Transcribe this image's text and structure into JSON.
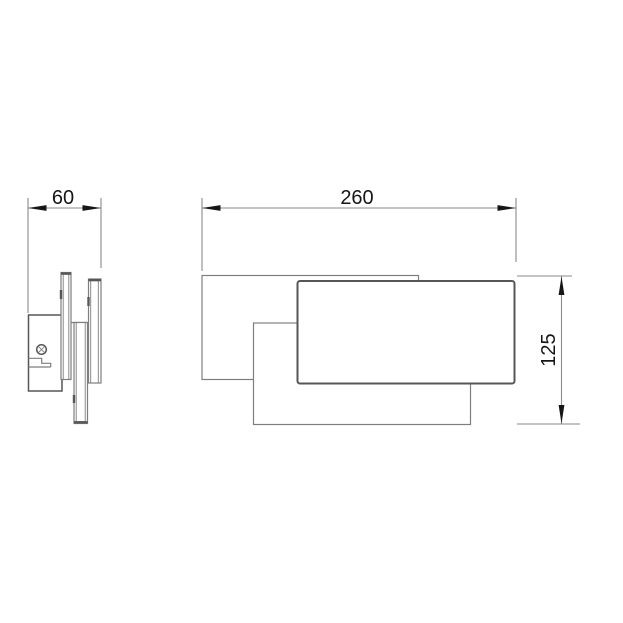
{
  "drawing": {
    "type": "technical-dimension-drawing",
    "views": {
      "side_view": {
        "dimension": {
          "label": "60",
          "orientation": "horizontal"
        }
      },
      "front_view": {
        "dimension_width": {
          "label": "260",
          "orientation": "horizontal"
        },
        "dimension_height": {
          "label": "125",
          "orientation": "vertical-rotated"
        }
      }
    },
    "dimensions": {
      "depth": "60",
      "width": "260",
      "height": "125"
    }
  },
  "colors": {
    "background": "#ffffff",
    "line_thin": "#7e7e7e",
    "line_medium": "#565656",
    "line_dim": "#8a8a8a",
    "line_dark": "#161616"
  }
}
